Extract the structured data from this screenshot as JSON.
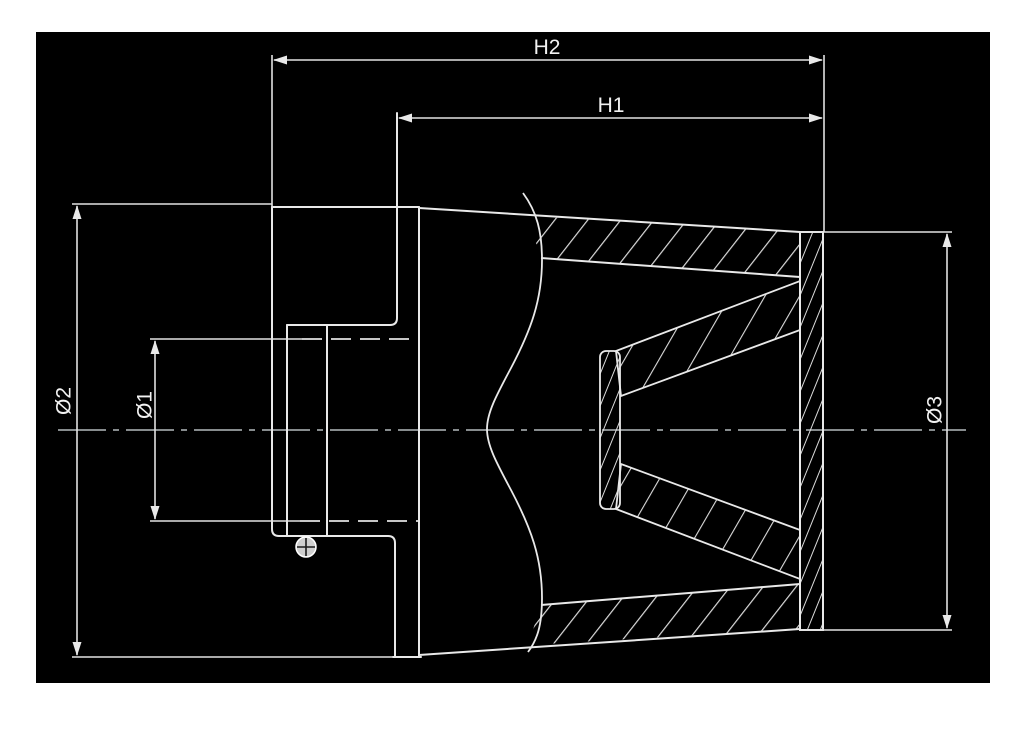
{
  "drawing": {
    "description": "Cross-section technical drawing of a conical air filter with rubber base, inlet collar, filter media cone, inner cone and end cap",
    "dimensions": {
      "h2": {
        "label": "H2"
      },
      "h1": {
        "label": "H1"
      },
      "d1": {
        "label": "Ø1"
      },
      "d2": {
        "label": "Ø2"
      },
      "d3": {
        "label": "Ø3"
      }
    },
    "colors": {
      "page": "#ffffff",
      "canvas": "#000000",
      "line": "#e9e9e9",
      "dimension_line": "#e2e2e2",
      "centerline": "#9aa0a2",
      "hatch": "#dcdcdc"
    }
  }
}
